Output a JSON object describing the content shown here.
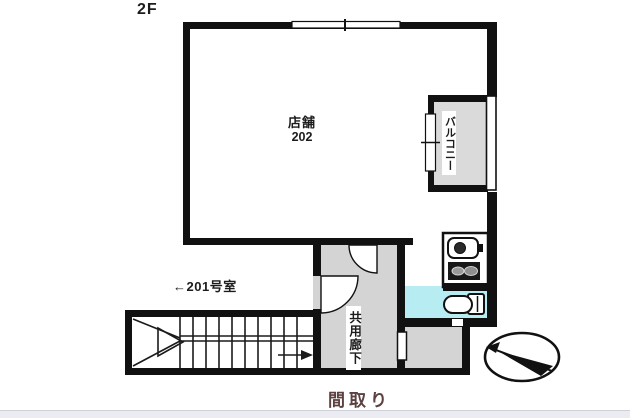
{
  "plan": {
    "floor_label": "2F",
    "shop": {
      "name": "店舗",
      "number": "202"
    },
    "balcony_label": "バルコニー",
    "corridor_label": "共用廊下",
    "neighbor_label": "←201号室",
    "caption": "間取り"
  },
  "fixtures": {
    "kitchen": [
      "sink",
      "stove"
    ],
    "sanitary": [
      "toilet"
    ],
    "circulation": [
      "staircase-with-up-arrow",
      "door-arcs"
    ],
    "orientation": [
      "north-compass"
    ]
  },
  "colors": {
    "wall": "#111111",
    "corridor_fill": "#d4d4d4",
    "balcony_fill": "#dadada",
    "toilet_fill": "#b7ecf2",
    "caption_text": "#5d4040",
    "footer_strip": "#ebecf1"
  }
}
